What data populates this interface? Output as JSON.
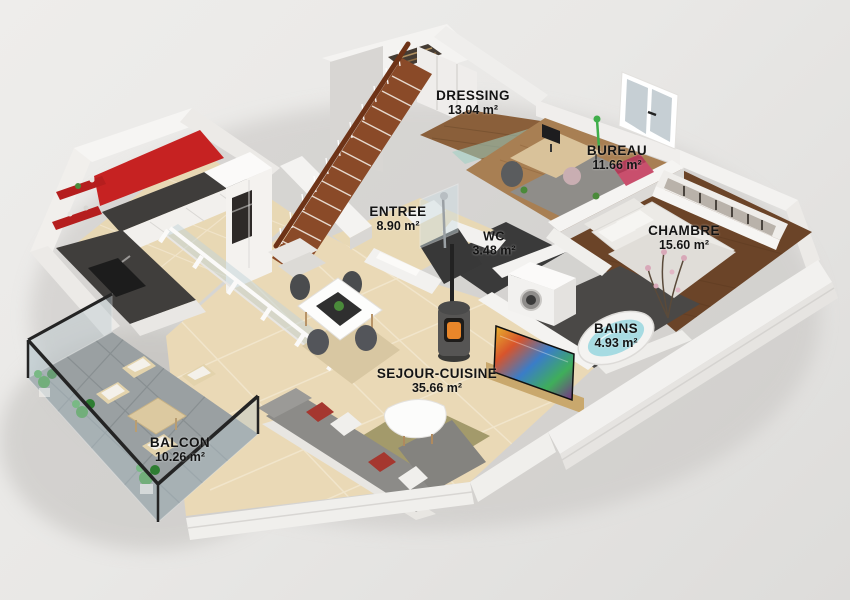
{
  "scene": {
    "type": "3d-floor-plan-render",
    "description": "Isometric 3D rendering of a one-bedroom apartment with balcony and staircase"
  },
  "rooms": [
    {
      "name": "DRESSING",
      "area": "13.04 m²"
    },
    {
      "name": "BUREAU",
      "area": "11.66 m²"
    },
    {
      "name": "ENTREE",
      "area": "8.90 m²"
    },
    {
      "name": "WC",
      "area": "3.48 m²"
    },
    {
      "name": "CHAMBRE",
      "area": "15.60 m²"
    },
    {
      "name": "BAINS",
      "area": "4.93 m²"
    },
    {
      "name": "SEJOUR-CUISINE",
      "area": "35.66 m²"
    },
    {
      "name": "BALCON",
      "area": "10.26 m²"
    }
  ],
  "colors": {
    "background": "#e7e6e4",
    "wall_light": "#f4f3f1",
    "wall_shade": "#d8d6d3",
    "kitchen_accent_red": "#c62222",
    "counter_dark": "#3f3d3b",
    "floor_tile_beige": "#ead9b6",
    "wood_floor_dark": "#6b4428",
    "wood_floor_mid": "#8a5f3a",
    "wood_floor_light": "#a87f53",
    "stair_wood": "#8a4a28",
    "balcony_tile_gray": "#9aa0a2",
    "bath_water_blue": "#a6dbe2",
    "sofa_gray": "#8c8b88",
    "pillow_red": "#a5372f",
    "rug_olive": "#a39a6b",
    "rug_beige": "#d8c7a2",
    "plant_green": "#3f9b3f"
  }
}
